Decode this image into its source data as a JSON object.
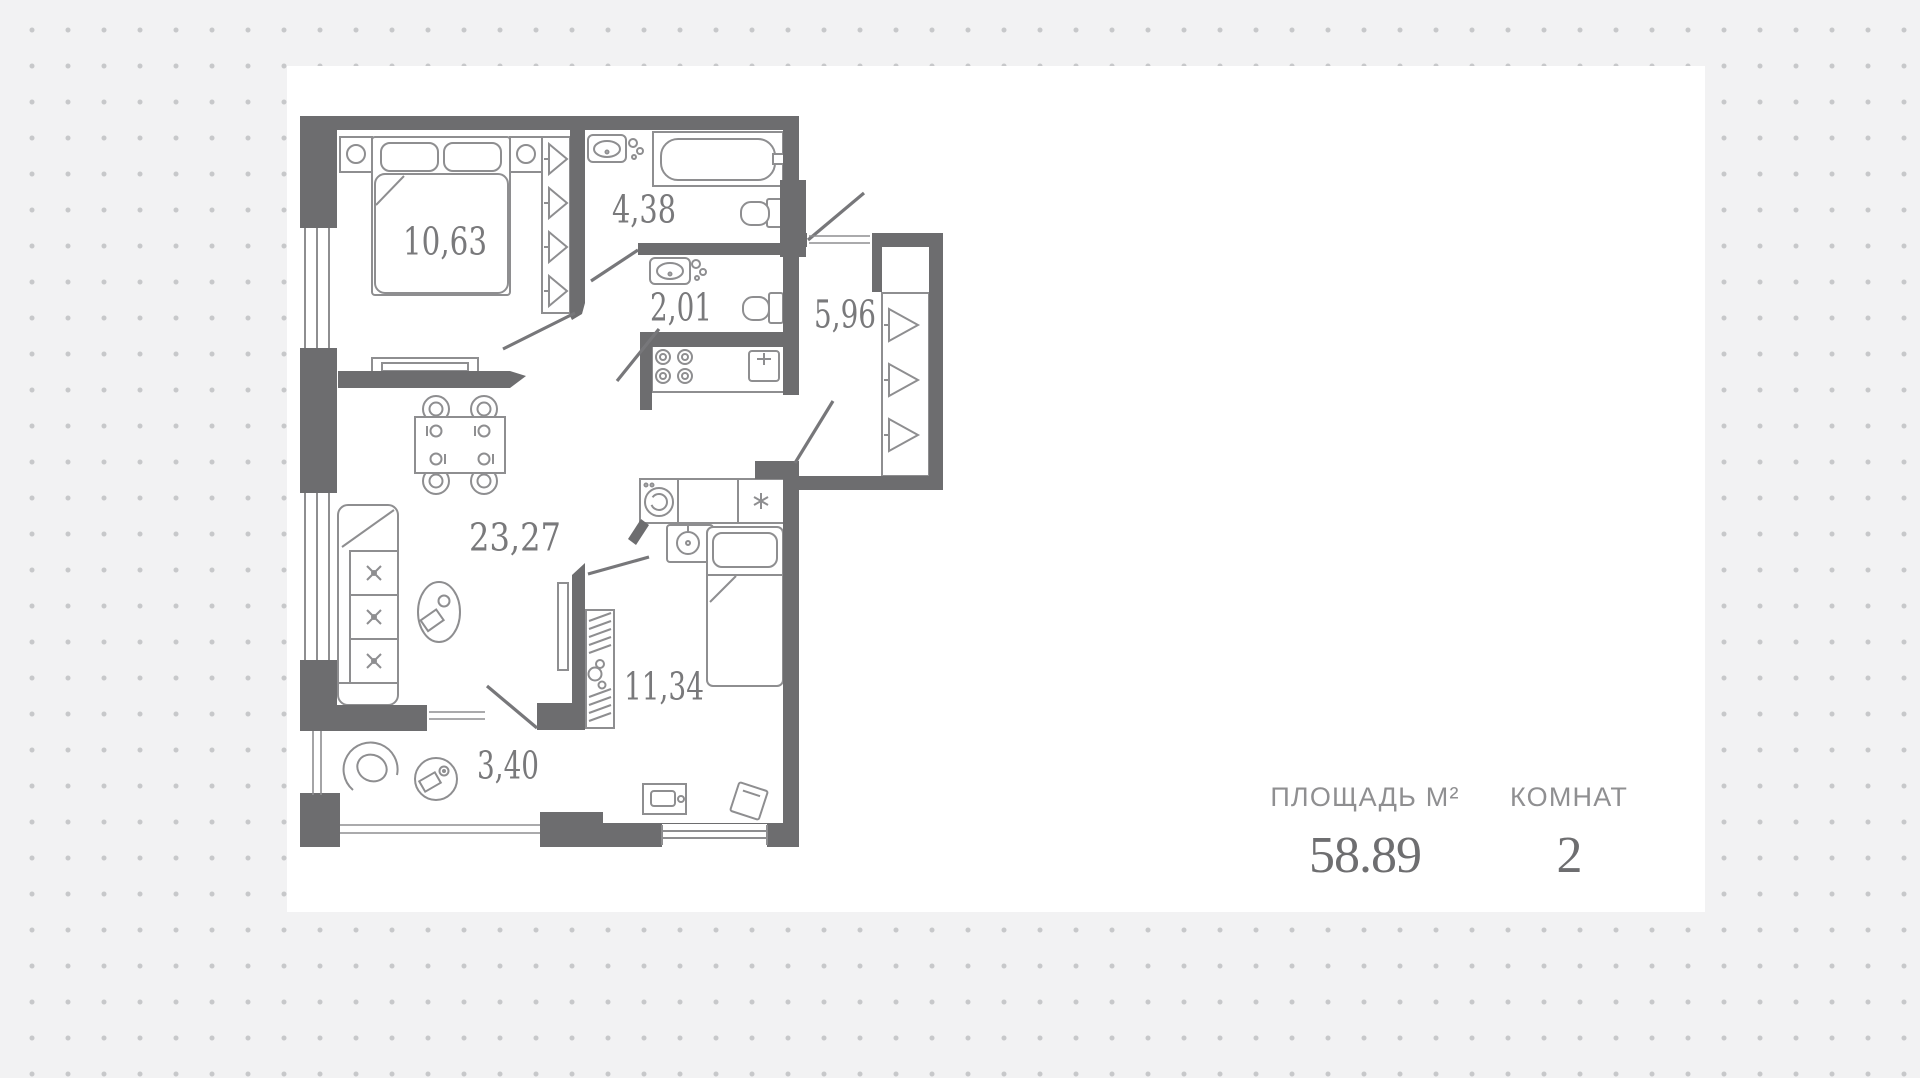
{
  "floor_plan": {
    "rooms": [
      {
        "id": "living-kitchen",
        "area": "23,27"
      },
      {
        "id": "bedroom-1",
        "area": "10,63"
      },
      {
        "id": "bedroom-2",
        "area": "11,34"
      },
      {
        "id": "hallway",
        "area": "5,96"
      },
      {
        "id": "bathroom",
        "area": "4,38"
      },
      {
        "id": "wc",
        "area": "2,01"
      },
      {
        "id": "balcony",
        "area": "3,40"
      }
    ],
    "colors": {
      "wall": "#6d6d6f",
      "furniture_stroke": "#8e8e90",
      "label": "#79797b"
    }
  },
  "stats": {
    "area": {
      "label": "ПЛОЩАДЬ М²",
      "value": "58.89"
    },
    "rooms": {
      "label": "КОМНАТ",
      "value": "2"
    }
  }
}
